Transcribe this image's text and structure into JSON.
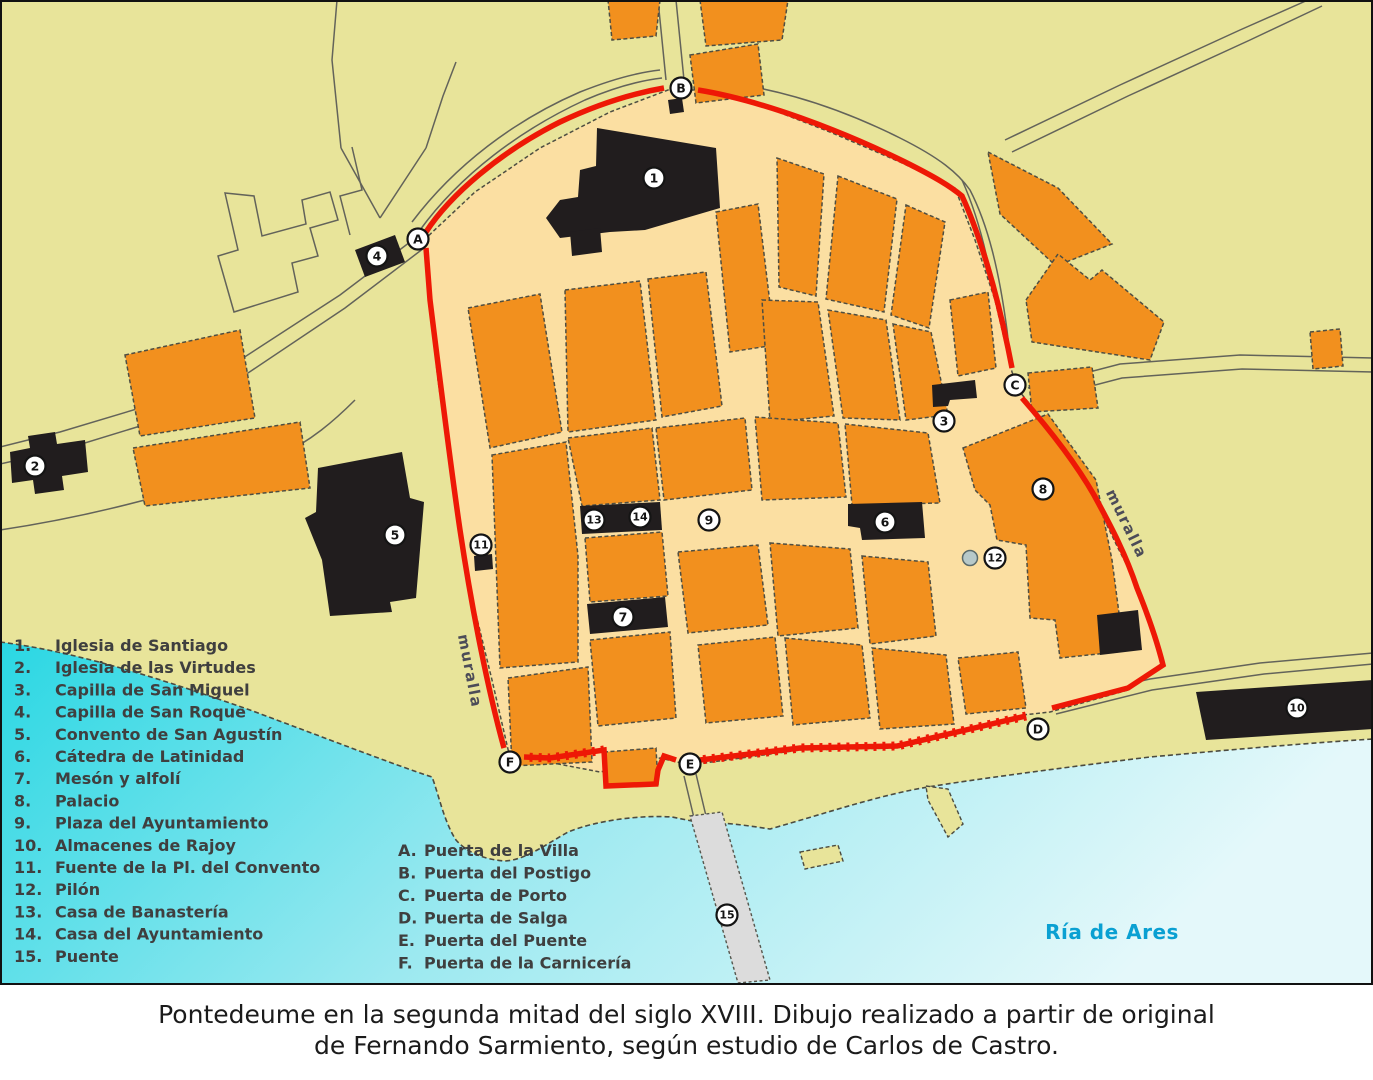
{
  "map": {
    "labels": {
      "muralla_left": "muralla",
      "muralla_right": "muralla",
      "ria": "Ría de Ares"
    },
    "legend_numbered": [
      {
        "num": "1.",
        "label": "Iglesia de Santiago"
      },
      {
        "num": "2.",
        "label": "Iglesia de las Virtudes"
      },
      {
        "num": "3.",
        "label": "Capilla de San Miguel"
      },
      {
        "num": "4.",
        "label": "Capilla de San Roque"
      },
      {
        "num": "5.",
        "label": "Convento de San Agustín"
      },
      {
        "num": "6.",
        "label": "Cátedra de Latinidad"
      },
      {
        "num": "7.",
        "label": "Mesón y alfolí"
      },
      {
        "num": "8.",
        "label": "Palacio"
      },
      {
        "num": "9.",
        "label": "Plaza del Ayuntamiento"
      },
      {
        "num": "10.",
        "label": "Almacenes de Rajoy"
      },
      {
        "num": "11.",
        "label": "Fuente de la Pl. del Convento"
      },
      {
        "num": "12.",
        "label": "Pilón"
      },
      {
        "num": "13.",
        "label": "Casa de Banastería"
      },
      {
        "num": "14.",
        "label": "Casa del Ayuntamiento"
      },
      {
        "num": "15.",
        "label": "Puente"
      }
    ],
    "legend_lettered": [
      {
        "num": "A.",
        "label": "Puerta de la Villa"
      },
      {
        "num": "B.",
        "label": "Puerta del Postigo"
      },
      {
        "num": "C.",
        "label": "Puerta de Porto"
      },
      {
        "num": "D.",
        "label": "Puerta de Salga"
      },
      {
        "num": "E.",
        "label": "Puerta del Puente"
      },
      {
        "num": "F.",
        "label": "Puerta de la Carnicería"
      }
    ],
    "markers": [
      {
        "id": "1",
        "x": 654,
        "y": 178
      },
      {
        "id": "2",
        "x": 35,
        "y": 466
      },
      {
        "id": "3",
        "x": 944,
        "y": 421
      },
      {
        "id": "4",
        "x": 377,
        "y": 256
      },
      {
        "id": "5",
        "x": 395,
        "y": 535
      },
      {
        "id": "6",
        "x": 885,
        "y": 522
      },
      {
        "id": "7",
        "x": 623,
        "y": 617
      },
      {
        "id": "8",
        "x": 1043,
        "y": 489
      },
      {
        "id": "9",
        "x": 709,
        "y": 520
      },
      {
        "id": "10",
        "x": 1297,
        "y": 708
      },
      {
        "id": "11",
        "x": 481,
        "y": 545
      },
      {
        "id": "12",
        "x": 995,
        "y": 558
      },
      {
        "id": "13",
        "x": 594,
        "y": 520
      },
      {
        "id": "14",
        "x": 640,
        "y": 517
      },
      {
        "id": "15",
        "x": 727,
        "y": 915
      },
      {
        "id": "A",
        "x": 418,
        "y": 239
      },
      {
        "id": "B",
        "x": 681,
        "y": 88
      },
      {
        "id": "C",
        "x": 1015,
        "y": 385
      },
      {
        "id": "D",
        "x": 1038,
        "y": 729
      },
      {
        "id": "E",
        "x": 690,
        "y": 764
      },
      {
        "id": "F",
        "x": 510,
        "y": 762
      }
    ],
    "colors": {
      "bg": "#e8e49a",
      "cream": "#fbdfa2",
      "orange": "#f2901e",
      "wall": "#ee1806",
      "bblack": "#211d1e",
      "water_deep": "#2ad7e3",
      "water_pale": "#e4f8fa",
      "ria_text": "#0aa0d2"
    }
  },
  "caption": {
    "line1": "Pontedeume en la segunda mitad del siglo XVIII. Dibujo realizado a partir de original",
    "line2": "de Fernando Sarmiento, según estudio de Carlos de Castro."
  }
}
